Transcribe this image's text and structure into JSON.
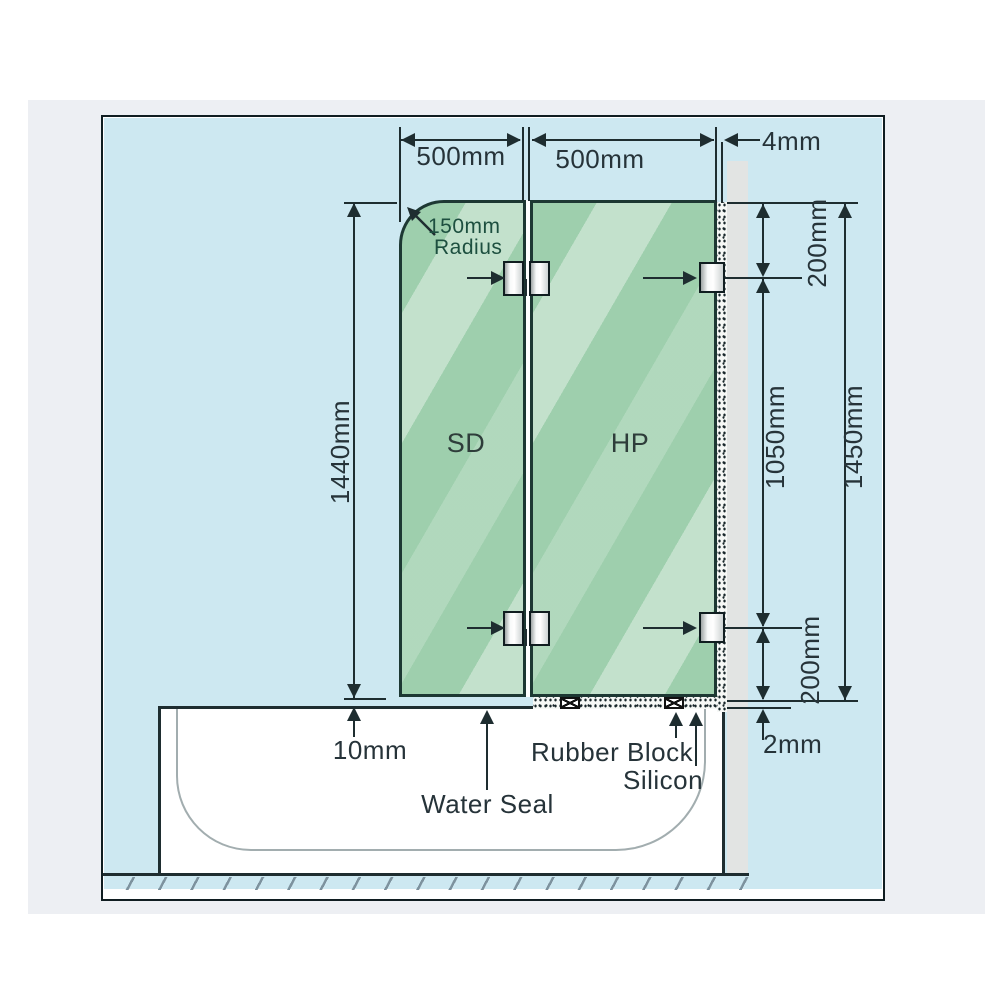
{
  "dims": {
    "sd_width": "500mm",
    "hp_width": "500mm",
    "wall_gap": "4mm",
    "glass_height": "1440mm",
    "top_offset": "200mm",
    "mid_span": "1050mm",
    "total_height": "1450mm",
    "bottom_offset": "200mm",
    "base_gap": "2mm",
    "tub_gap": "10mm"
  },
  "labels": {
    "radius_line1": "150mm",
    "radius_line2": "Radius",
    "water_seal": "Water Seal",
    "rubber_block": "Rubber Block",
    "silicon": "Silicon"
  },
  "panels": {
    "left_label": "SD",
    "right_label": "HP"
  },
  "colors": {
    "page_background": "#ffffff",
    "backdrop": "#edeff3",
    "diagram_background": "#cde8f1",
    "glass": "#9ecfad",
    "glass_highlight": "#cdе9d2",
    "wall": "#e2e4e3",
    "line": "#1e2d30",
    "text": "#263339",
    "radius_note_text": "#1d4f3f",
    "tub": "#ffffff"
  }
}
